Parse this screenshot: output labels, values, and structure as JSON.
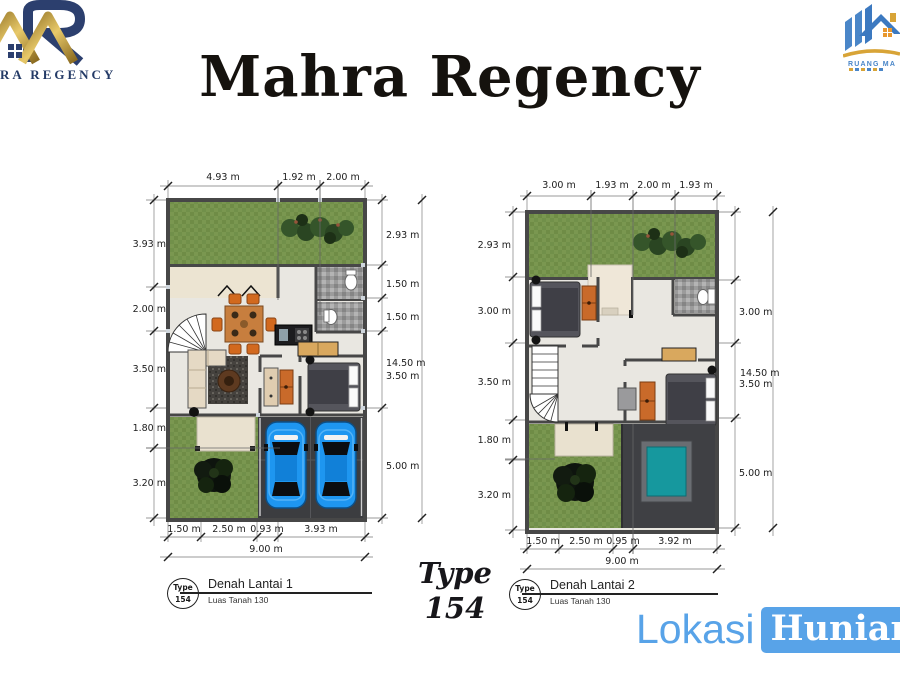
{
  "header": {
    "title": "Mahra Regency"
  },
  "logo_left": {
    "name": "RA REGENCY"
  },
  "logo_right": {
    "name": "RUANG MA"
  },
  "center_badge": {
    "line1": "Type",
    "line2": "154"
  },
  "plan1": {
    "title": "Denah Lantai 1",
    "subtitle": "Luas Tanah 130",
    "badge_top": "Type",
    "badge_bottom": "154",
    "dims_top": [
      "4.93 m",
      "1.92 m",
      "2.00 m"
    ],
    "dims_left": [
      "3.93 m",
      "2.00 m",
      "3.50 m",
      "1.80 m",
      "3.20 m"
    ],
    "dims_right": [
      "2.93 m",
      "1.50 m",
      "1.50 m",
      "3.50 m",
      "5.00 m"
    ],
    "dim_total_right": "14.50 m",
    "dims_bottom": [
      "1.50 m",
      "2.50 m",
      "0.93 m",
      "3.93 m"
    ],
    "dim_total_bottom": "9.00 m"
  },
  "plan2": {
    "title": "Denah Lantai 2",
    "subtitle": "Luas Tanah 130",
    "badge_top": "Type",
    "badge_bottom": "154",
    "dims_top": [
      "3.00 m",
      "1.93 m",
      "2.00 m",
      "1.93 m"
    ],
    "dims_left": [
      "2.93 m",
      "3.00 m",
      "3.50 m",
      "1.80 m",
      "3.20 m"
    ],
    "dims_right": [
      "3.00 m",
      "3.50 m",
      "5.00 m"
    ],
    "dim_total_right": "14.50 m",
    "dims_bottom": [
      "1.50 m",
      "2.50 m",
      "0.95 m",
      "3.92 m"
    ],
    "dim_total_bottom": "9.00 m"
  },
  "watermark": {
    "part1": "Lokasi",
    "part2": "Hunian"
  },
  "colors": {
    "accent_blue": "#58a3e8",
    "logo_navy": "#2c3f6e",
    "logo_gold": "#c9a24b",
    "grass_green": "#7a9750",
    "carport_gray": "#3c3d40",
    "car_blue": "#1e96f0",
    "pool_teal": "#16989e"
  }
}
